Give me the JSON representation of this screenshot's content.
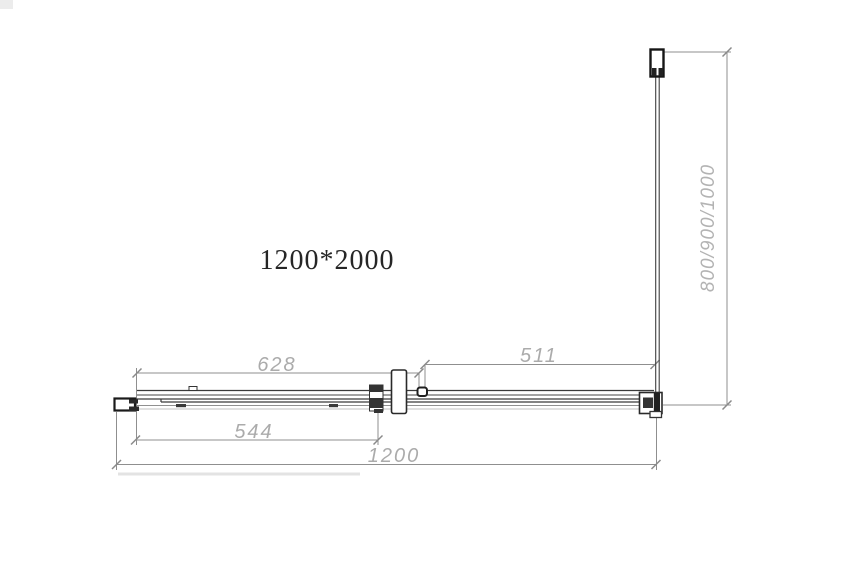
{
  "title": "1200*2000",
  "dimensions": {
    "top_left_width": "628",
    "top_right_width": "511",
    "inner_width": "544",
    "total_width": "1200",
    "side_panel_depth": "800/900/1000"
  },
  "colors": {
    "background": "#ffffff",
    "drawing_line": "#3a3a3a",
    "profile_line": "#1c1c1c",
    "dimension_line": "#8f8f8f",
    "dimension_text": "#ababab",
    "title_text": "#262626"
  }
}
